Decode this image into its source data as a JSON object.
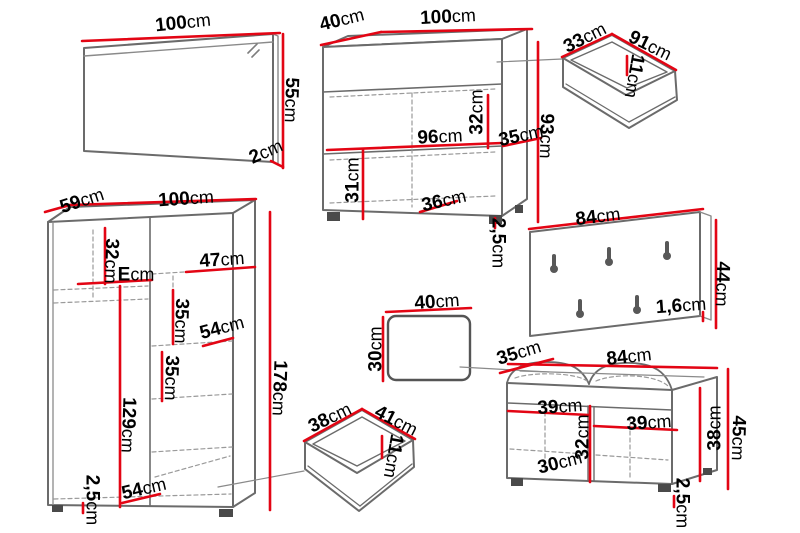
{
  "diagram_title": "Hallway furniture set dimensions",
  "unit": "cm",
  "colors": {
    "dimension_red": "#e30514",
    "outline_gray": "#666666",
    "dashed_gray": "#9a9a9a",
    "text_black": "#000000"
  },
  "pieces": {
    "mirror": {
      "width": "100cm",
      "height": "55cm",
      "depth": "2cm"
    },
    "chest": {
      "depth": "40cm",
      "width": "100cm",
      "inner_height": "32cm",
      "inner_width": "96cm",
      "side_offset": "35cm",
      "lower_inner_height": "31cm",
      "shelf_width": "36cm",
      "height": "93cm",
      "plinth": "2,5cm"
    },
    "drawer_top": {
      "depth": "33cm",
      "width": "91cm",
      "height": "11cm"
    },
    "coat_panel": {
      "width": "84cm",
      "height": "44cm",
      "thickness": "1,6cm"
    },
    "wardrobe": {
      "depth": "59cm",
      "width": "100cm",
      "top_section": "32cm",
      "shelf_e": "Ecm",
      "shelf_right": "47cm",
      "mid_section": "35cm",
      "shelf_upper": "54cm",
      "lower_section": "35cm",
      "hanging_space": "129cm",
      "height": "178cm",
      "plinth": "2,5cm",
      "bottom_width": "54cm"
    },
    "cushion": {
      "width": "40cm",
      "height": "30cm"
    },
    "drawer_bottom": {
      "depth": "38cm",
      "width": "41cm",
      "height": "11cm"
    },
    "bench": {
      "depth": "35cm",
      "width": "84cm",
      "left_compartment": "39cm",
      "right_compartment": "39cm",
      "mid_height": "32cm",
      "inner_height": "38cm",
      "bottom_shelf": "30cm",
      "height": "45cm",
      "plinth": "2,5cm"
    }
  }
}
